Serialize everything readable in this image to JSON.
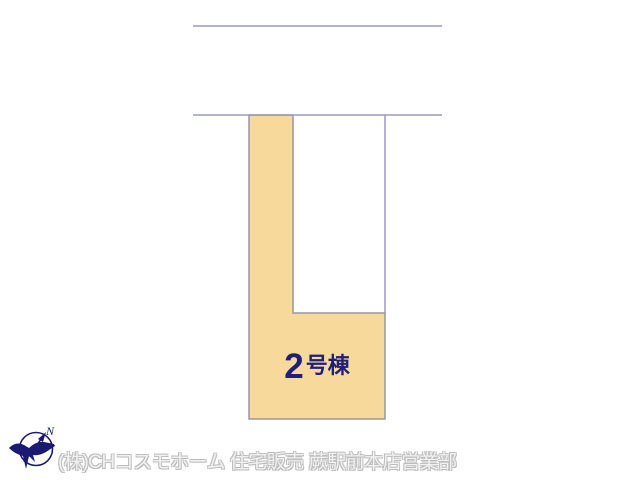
{
  "plan": {
    "lot": {
      "id": "2号棟",
      "label_number": "2",
      "label_suffix": "号棟",
      "fill_color": "#F7D99C",
      "border_color": "#97979C",
      "label_color": "#20207A"
    },
    "roads": {
      "line_color": "#9A9AC2"
    }
  },
  "compass": {
    "north_label": "N",
    "color": "#1A1A72"
  },
  "footer": {
    "company_text": "(株)CHコスモホーム 住宅販売 蕨駅前本店営業部",
    "text_color": "#C6C6C6"
  }
}
